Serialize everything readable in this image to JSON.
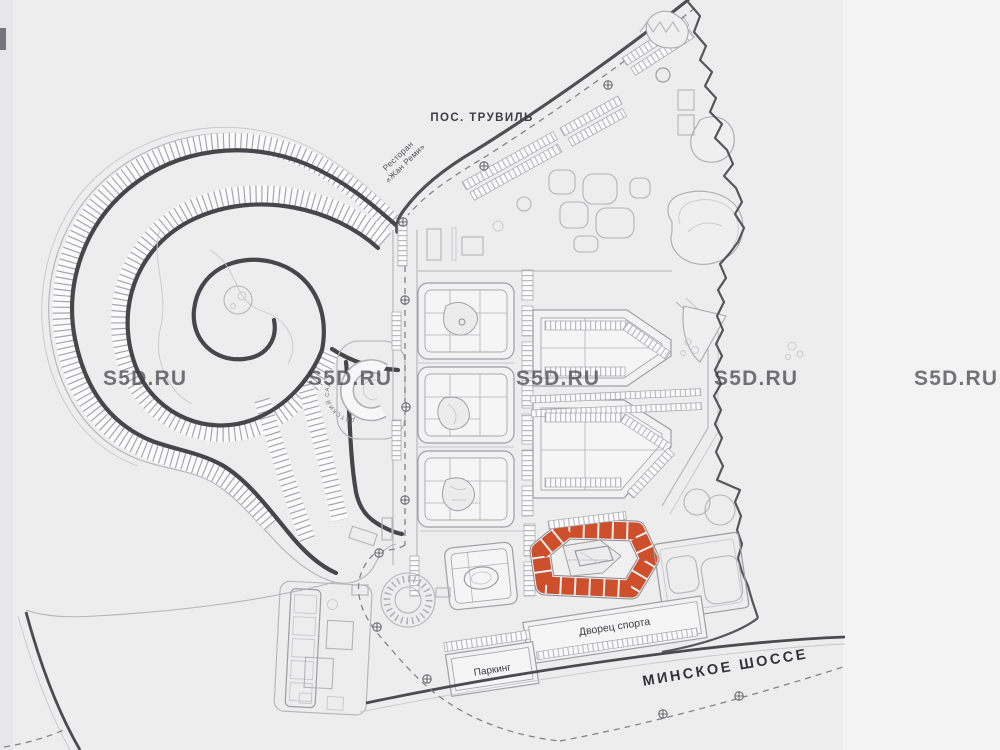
{
  "page": {
    "type": "residential development master plan",
    "watermark": "S5D.RU"
  },
  "labels": {
    "settlement": "ПОС. ТРУВИЛЬ",
    "restaurant_line1": "Ресторан",
    "restaurant_line2": "«Жан Реми»",
    "highway": "МИНСКОЕ ШОССЕ",
    "parking": "Паркинг",
    "sports_palace": "Дворец спорта",
    "kindergarten": "ДЕТСКИЙ САД"
  },
  "highlight": {
    "name": "selected building block",
    "color": "#cd4f2b"
  },
  "colors": {
    "background": "#ededee",
    "background_right": "#f3f3f4",
    "accent": "#cd4f2b",
    "road_dark": "#47474b",
    "line_light": "#b4b4b8",
    "text": "#3e3e42",
    "watermark": "#fdfdfe"
  }
}
